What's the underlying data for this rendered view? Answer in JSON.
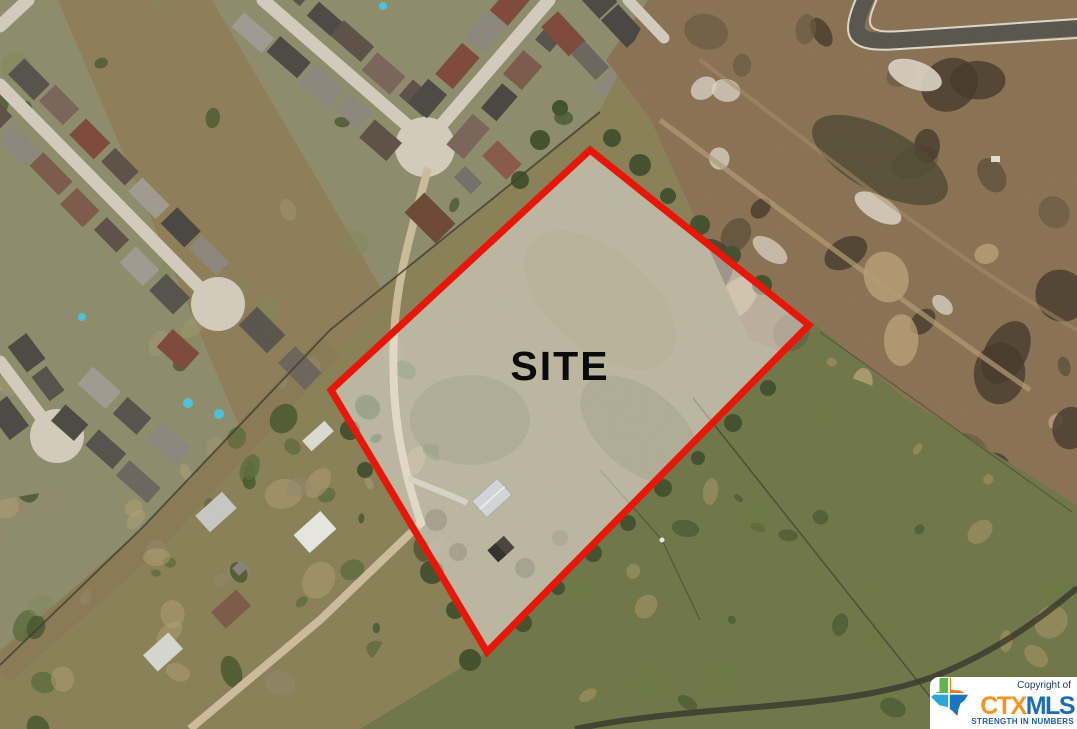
{
  "annotation": {
    "site_label": "SITE",
    "site_polygon_points": "590,150 809,325 487,652 331,390",
    "site_outline_color": "#e91508",
    "site_fill": "rgba(255,255,255,0.44)"
  },
  "watermark": {
    "copyright_prefix": "Copyright of",
    "brand_ctx": "CTX",
    "brand_mls": "MLS",
    "tagline": "STRENGTH IN NUMBERS",
    "colors": {
      "ctx_orange": "#f7941e",
      "mls_blue": "#1b6cb5",
      "tagline_blue": "#1b5fa8",
      "copyright_navy": "#1d3a5f",
      "texas_green": "#5cb848",
      "texas_orange": "#f47b20",
      "texas_teal": "#29a8d8",
      "texas_blue": "#1b75bc",
      "box_bg": "#ffffff"
    }
  }
}
